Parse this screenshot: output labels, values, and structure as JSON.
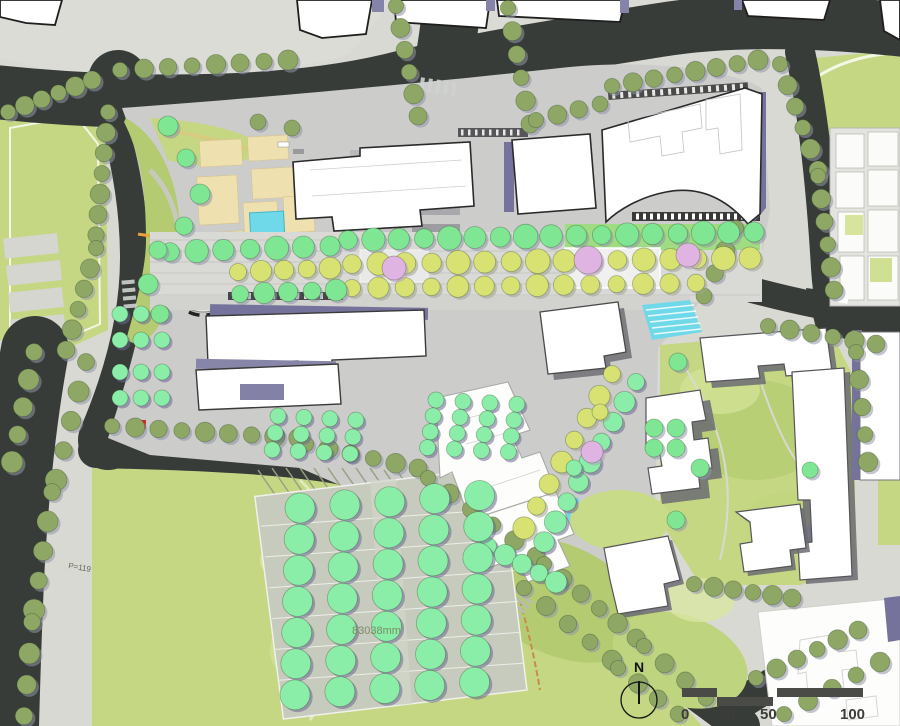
{
  "map": {
    "type": "landscape-master-plan",
    "labels": {
      "area_dimension": "83038mm",
      "parking_count": "P=119",
      "north": "N"
    },
    "scale_bar": {
      "ticks": [
        "0",
        "20",
        "50",
        "100"
      ]
    },
    "colors": {
      "road": "#373c38",
      "sidewalk": "#d9d9d4",
      "sidewalk_light": "#dcdcd7",
      "site_paving": "#cccccb",
      "park_green": "#c5d783",
      "park_light": "#d7e59c",
      "park_dark": "#b4cb72",
      "olive": "#8ea765",
      "bright": "#7fe793",
      "mint": "#8beea8",
      "yellow": "#d8e273",
      "pink": "#dfb3e2",
      "water": "#6fd9ea",
      "plaza_beige": "#efe0b0",
      "building_fill": "#ffffff",
      "building_stroke": "#2a2a2a",
      "shadow_purple": "#75739b",
      "accent_orange": "#e8a13c",
      "accent_red": "#cc2a2a",
      "accent_blue": "#98a2e2"
    },
    "tree_shadows": {
      "olive": "#9196a7",
      "bright": "#8f95aa",
      "mint": "#6b6892",
      "yellow": "#a0a491",
      "pink": "#b79cc0"
    }
  },
  "render": {
    "street_rows": [
      [
        8,
        112,
        92,
        80,
        6,
        9,
        "olive"
      ],
      [
        108,
        112,
        96,
        235,
        7,
        9,
        "olive"
      ],
      [
        96,
        248,
        66,
        350,
        6,
        9,
        "olive"
      ],
      [
        120,
        70,
        288,
        60,
        8,
        9,
        "olive"
      ],
      [
        396,
        6,
        418,
        116,
        6,
        9,
        "olive"
      ],
      [
        508,
        8,
        530,
        124,
        6,
        9,
        "olive"
      ],
      [
        536,
        120,
        600,
        104,
        4,
        9,
        "olive"
      ],
      [
        612,
        86,
        758,
        60,
        8,
        9,
        "olive"
      ],
      [
        780,
        64,
        818,
        170,
        6,
        9,
        "olive"
      ],
      [
        818,
        176,
        834,
        290,
        6,
        9,
        "olive"
      ],
      [
        736,
        228,
        704,
        296,
        4,
        9,
        "olive"
      ],
      [
        34,
        352,
        12,
        462,
        5,
        10,
        "olive"
      ],
      [
        86,
        362,
        56,
        480,
        5,
        10,
        "olive"
      ],
      [
        52,
        492,
        34,
        610,
        5,
        10,
        "olive"
      ],
      [
        32,
        622,
        24,
        716,
        4,
        10,
        "olive"
      ],
      [
        112,
        426,
        298,
        438,
        9,
        9,
        "olive"
      ],
      [
        306,
        444,
        418,
        468,
        6,
        9,
        "olive"
      ],
      [
        428,
        478,
        536,
        556,
        6,
        9,
        "olive"
      ],
      [
        544,
        564,
        636,
        638,
        6,
        9,
        "olive"
      ],
      [
        644,
        646,
        706,
        698,
        4,
        9,
        "olive"
      ],
      [
        524,
        588,
        612,
        660,
        5,
        9,
        "olive"
      ],
      [
        618,
        668,
        678,
        714,
        4,
        9,
        "olive"
      ],
      [
        756,
        678,
        858,
        630,
        6,
        9,
        "olive"
      ],
      [
        784,
        714,
        880,
        662,
        5,
        9,
        "olive"
      ],
      [
        694,
        584,
        792,
        598,
        6,
        9,
        "olive"
      ],
      [
        768,
        326,
        876,
        344,
        6,
        9,
        "olive"
      ],
      [
        856,
        352,
        868,
        462,
        5,
        9,
        "olive"
      ]
    ],
    "axis_rows": [
      [
        348,
        240,
        754,
        232,
        17,
        11,
        "bright"
      ],
      [
        352,
        264,
        750,
        258,
        16,
        11,
        "yellow"
      ],
      [
        352,
        288,
        696,
        283,
        14,
        10,
        "yellow"
      ],
      [
        170,
        252,
        330,
        246,
        7,
        11,
        "bright"
      ],
      [
        238,
        272,
        330,
        268,
        5,
        10,
        "yellow"
      ],
      [
        240,
        294,
        336,
        290,
        5,
        10,
        "bright"
      ],
      [
        636,
        382,
        544,
        542,
        9,
        10,
        "mint"
      ],
      [
        612,
        374,
        524,
        528,
        8,
        10,
        "yellow"
      ],
      [
        488,
        546,
        556,
        582,
        5,
        10,
        "mint"
      ]
    ],
    "grids": [
      [
        278,
        416,
        4,
        3,
        26,
        17,
        8,
        "mint",
        3,
        -2
      ],
      [
        436,
        400,
        4,
        4,
        27,
        16,
        8,
        "mint",
        3,
        -2
      ],
      [
        120,
        314,
        3,
        2,
        21,
        26,
        8,
        "mint",
        0,
        0
      ],
      [
        120,
        372,
        3,
        2,
        21,
        26,
        8,
        "mint",
        0,
        0
      ],
      [
        300,
        508,
        5,
        7,
        45,
        31,
        15,
        "mint",
        -4,
        -3
      ],
      [
        654,
        428,
        2,
        2,
        22,
        20,
        9,
        "bright",
        0,
        0
      ]
    ],
    "singles": [
      [
        394,
        268,
        12,
        "pink"
      ],
      [
        588,
        260,
        14,
        "pink"
      ],
      [
        688,
        255,
        12,
        "pink"
      ],
      [
        592,
        452,
        11,
        "pink"
      ],
      [
        168,
        126,
        10,
        "bright"
      ],
      [
        186,
        158,
        9,
        "bright"
      ],
      [
        200,
        194,
        10,
        "bright"
      ],
      [
        184,
        226,
        9,
        "bright"
      ],
      [
        158,
        250,
        9,
        "bright"
      ],
      [
        148,
        284,
        10,
        "bright"
      ],
      [
        160,
        314,
        9,
        "bright"
      ],
      [
        678,
        362,
        9,
        "bright"
      ],
      [
        700,
        468,
        9,
        "bright"
      ],
      [
        676,
        520,
        9,
        "bright"
      ],
      [
        810,
        470,
        8,
        "bright"
      ],
      [
        600,
        412,
        8,
        "yellow"
      ],
      [
        574,
        468,
        8,
        "mint"
      ],
      [
        258,
        122,
        8,
        "olive"
      ],
      [
        292,
        128,
        8,
        "olive"
      ]
    ]
  }
}
